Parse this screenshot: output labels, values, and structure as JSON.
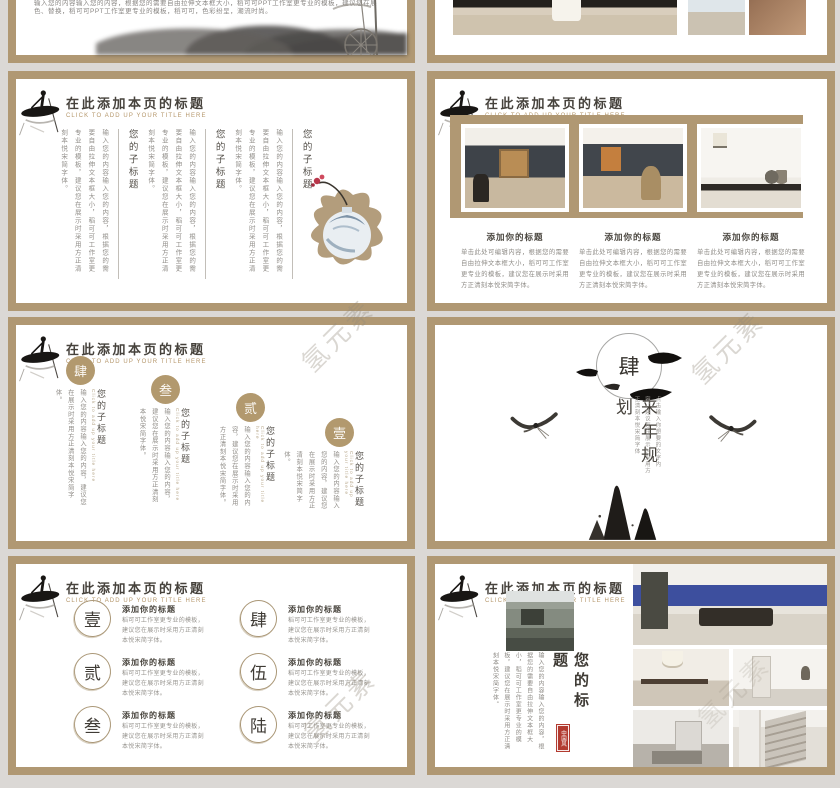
{
  "watermark": "氢元素",
  "header": {
    "title": "在此添加本页的标题",
    "subtitle": "CLICK TO ADD UP YOUR TITLE HERE"
  },
  "slide_intro": {
    "line1": "输入您的内容输入您的内容，根据您的需要自由拉伸文本框大小，稻可可PPT工作室更专业的模板，建议您在展示时采用方正清刻本悦宋简字体，颜",
    "line2": "色、替换，稻可可PPT工作室更专业的模板，稻可可，色彩纷呈，潮流时尚。"
  },
  "slide_columns": {
    "groups": [
      {
        "heading": "您的子标题",
        "body": "输入您的内容输入您的内容，根据您的需要自由拉伸文本框大小，稻可可工作室更专业的模板，建议您在展示时采用方正清刻本悦宋简字体。"
      },
      {
        "heading": "您的子标题",
        "body": "输入您的内容输入您的内容，根据您的需要自由拉伸文本框大小，稻可可工作室更专业的模板，建议您在展示时采用方正清刻本悦宋简字体。"
      },
      {
        "heading": "您的子标题",
        "body": "输入您的内容输入您的内容，根据您的需要自由拉伸文本框大小，稻可可工作室更专业的模板，建议您在展示时采用方正清刻本悦宋简字体。"
      }
    ]
  },
  "slide_photos3": {
    "items": [
      {
        "heading": "添加你的标题",
        "body": "单击此处可编辑内容，根据您的需要自由拉伸文本框大小，稻可可工作室更专业的模板，建议您在展示时采用方正清刻本悦宋简字体。"
      },
      {
        "heading": "添加你的标题",
        "body": "单击此处可编辑内容，根据您的需要自由拉伸文本框大小，稻可可工作室更专业的模板，建议您在展示时采用方正清刻本悦宋简字体。"
      },
      {
        "heading": "添加你的标题",
        "body": "单击此处可编辑内容，根据您的需要自由拉伸文本框大小，稻可可工作室更专业的模板，建议您在展示时采用方正清刻本悦宋简字体。"
      }
    ]
  },
  "slide_steps": {
    "items": [
      {
        "num": "肆",
        "heading": "您的子标题",
        "note_en": "Click to add up your title here",
        "body": "输入您的内容输入您的内容，建议您在展示时采用方正清刻本悦宋简字体。"
      },
      {
        "num": "叁",
        "heading": "您的子标题",
        "note_en": "Click to add up your title here",
        "body": "输入您的内容输入您的内容，建议您在展示时采用方正清刻本悦宋简字体。"
      },
      {
        "num": "贰",
        "heading": "您的子标题",
        "note_en": "Click to add up your title here",
        "body": "输入您的内容输入您的内容，建议您在展示时采用方正清刻本悦宋简字体。"
      },
      {
        "num": "壹",
        "heading": "您的子标题",
        "note_en": "Click to add up your title here",
        "body": "输入您的内容输入您的内容，建议您在展示时采用方正清刻本悦宋简字体。"
      }
    ]
  },
  "slide_section": {
    "num": "肆",
    "title": "来年规划",
    "note": "点击输入你想要的文字内容，建议您在展示时采用方正清刻本悦宋简字体"
  },
  "slide_list6": {
    "items": [
      {
        "num": "壹",
        "heading": "添加你的标题",
        "body": "稻可可工作室更专业的模板，建议您在展示时采用方正清刻本悦宋简字体。"
      },
      {
        "num": "贰",
        "heading": "添加你的标题",
        "body": "稻可可工作室更专业的模板，建议您在展示时采用方正清刻本悦宋简字体。"
      },
      {
        "num": "叁",
        "heading": "添加你的标题",
        "body": "稻可可工作室更专业的模板，建议您在展示时采用方正清刻本悦宋简字体。"
      },
      {
        "num": "肆",
        "heading": "添加你的标题",
        "body": "稻可可工作室更专业的模板，建议您在展示时采用方正清刻本悦宋简字体。"
      },
      {
        "num": "伍",
        "heading": "添加你的标题",
        "body": "稻可可工作室更专业的模板，建议您在展示时采用方正清刻本悦宋简字体。"
      },
      {
        "num": "陆",
        "heading": "添加你的标题",
        "body": "稻可可工作室更专业的模板，建议您在展示时采用方正清刻本悦宋简字体。"
      }
    ]
  },
  "slide_gallery": {
    "title": "您的标题",
    "seal": "中国风",
    "body": "输入您的内容输入您的内容，根据您的需要自由拉伸文本框大小，稻可可工作室更专业的模板，建议您在展示时采用方正清刻本悦宋简字体。"
  }
}
